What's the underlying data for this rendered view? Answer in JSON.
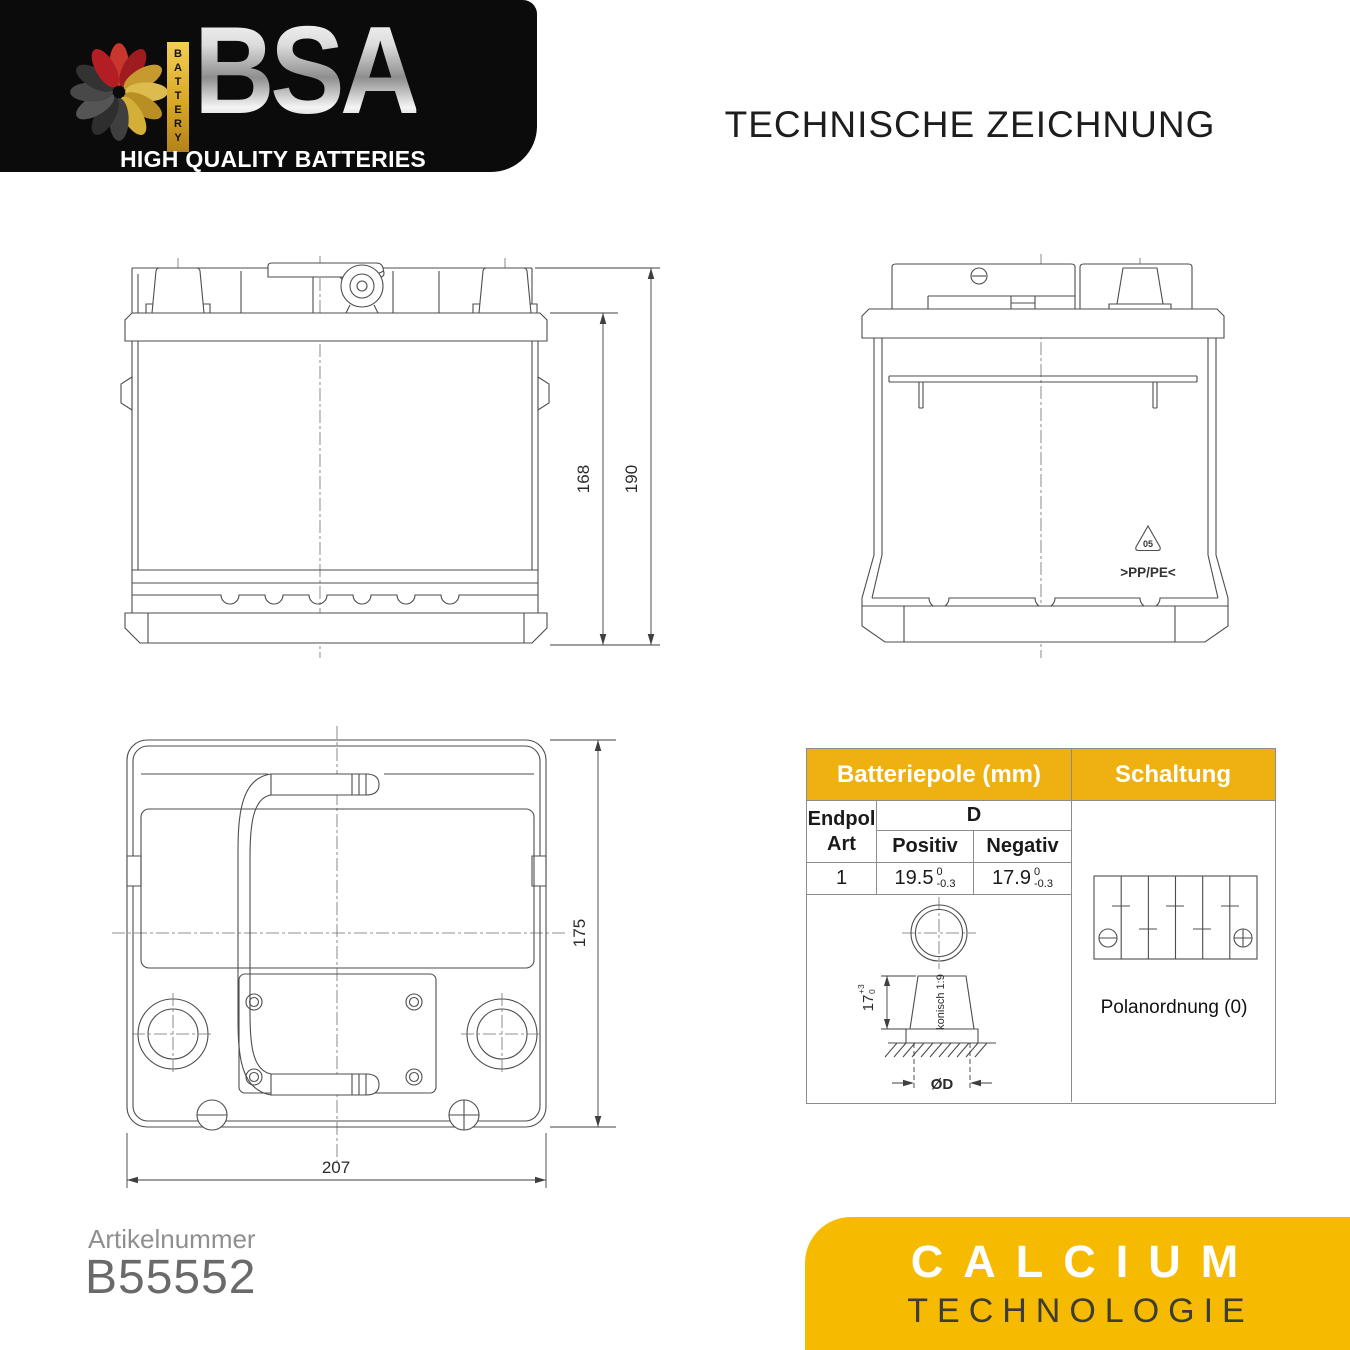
{
  "title": "TECHNISCHE ZEICHNUNG",
  "logo": {
    "brand": "BSA",
    "battery_label": "BATTERY",
    "tagline": "HIGH QUALITY BATTERIES"
  },
  "front_view": {
    "dim_case_height": "168",
    "dim_total_height": "190"
  },
  "side_view": {
    "recycling_code": "05",
    "material": ">PP/PE<"
  },
  "top_view": {
    "dim_depth": "175",
    "dim_length": "207"
  },
  "pole_table": {
    "header_left": "Batteriepole (mm)",
    "header_right": "Schaltung",
    "endpol_line1": "Endpol",
    "endpol_line2": "Art",
    "col_d": "D",
    "col_positiv": "Positiv",
    "col_negativ": "Negativ",
    "endpol_value": "1",
    "positiv_value": "19.5",
    "positiv_tol_top": "0",
    "positiv_tol_bottom": "-0.3",
    "negativ_value": "17.9",
    "negativ_tol_top": "0",
    "negativ_tol_bottom": "-0.3",
    "cone_dim": "17",
    "cone_tol_top": "+3",
    "cone_tol_bottom": "0",
    "taper_label": "konisch 1:9",
    "diameter_label": "ØD",
    "caption": "Polanordnung (0)"
  },
  "footer": {
    "article_label": "Artikelnummer",
    "article_number": "B55552",
    "tech_line1": "CALCIUM",
    "tech_line2": "TECHNOLOGIE"
  },
  "colors": {
    "amber_header": "#EEB111",
    "amber_box": "#F6BB00",
    "logo_bg": "#0B0B0B",
    "petal_red": "#C8372D",
    "petal_gold": "#D4AF37",
    "petal_dark": "#3F3F3F",
    "drawing_line": "#4D4D4D",
    "article_gray": "#6A6A6A"
  }
}
